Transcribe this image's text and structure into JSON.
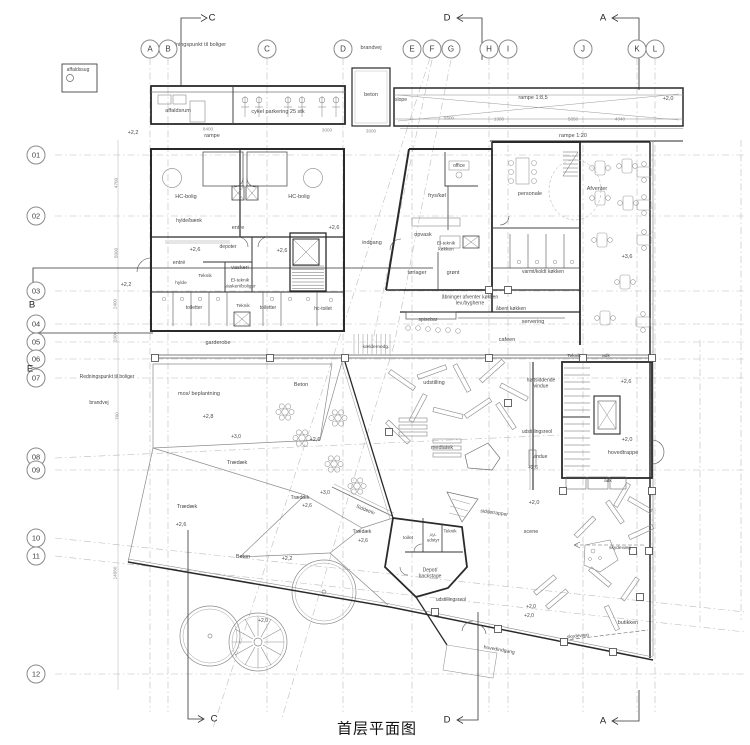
{
  "title": "首层平面图",
  "colors": {
    "wall": "#2a2a2a",
    "grid": "#b8b8b8",
    "label": "#4a4a4a",
    "furniture": "#909090"
  },
  "grid": {
    "column_bubble_y": 49,
    "row_bubble_x": 36,
    "columns": [
      {
        "label": "A",
        "x": 150
      },
      {
        "label": "B",
        "x": 168
      },
      {
        "label": "C",
        "x": 267
      },
      {
        "label": "D",
        "x": 343
      },
      {
        "label": "E",
        "x": 412
      },
      {
        "label": "F",
        "x": 432
      },
      {
        "label": "G",
        "x": 451
      },
      {
        "label": "H",
        "x": 489
      },
      {
        "label": "I",
        "x": 508
      },
      {
        "label": "J",
        "x": 583
      },
      {
        "label": "K",
        "x": 637
      },
      {
        "label": "L",
        "x": 655
      }
    ],
    "rows": [
      {
        "label": "01",
        "y": 155
      },
      {
        "label": "02",
        "y": 216
      },
      {
        "label": "03",
        "y": 291
      },
      {
        "label": "04",
        "y": 324
      },
      {
        "label": "05",
        "y": 342
      },
      {
        "label": "06",
        "y": 359
      },
      {
        "label": "07",
        "y": 378
      },
      {
        "label": "08",
        "y": 457
      },
      {
        "label": "09",
        "y": 470
      },
      {
        "label": "10",
        "y": 538
      },
      {
        "label": "11",
        "y": 556
      },
      {
        "label": "12",
        "y": 674
      }
    ]
  },
  "section_markers": [
    {
      "label": "C",
      "x": 212,
      "y": 18,
      "pos": "top"
    },
    {
      "label": "D",
      "x": 447,
      "y": 18,
      "pos": "top"
    },
    {
      "label": "A",
      "x": 603,
      "y": 18,
      "pos": "top"
    },
    {
      "label": "B",
      "x": 32,
      "y": 305,
      "pos": "left"
    },
    {
      "label": "E",
      "x": 30,
      "y": 369,
      "pos": "left"
    },
    {
      "label": "C",
      "x": 214,
      "y": 719,
      "pos": "bottom"
    },
    {
      "label": "D",
      "x": 447,
      "y": 720,
      "pos": "bottom"
    },
    {
      "label": "A",
      "x": 603,
      "y": 721,
      "pos": "bottom"
    }
  ],
  "labels": [
    {
      "t": "Redningspunkt til boliger",
      "x": 196,
      "y": 45,
      "s": 5.5
    },
    {
      "t": "brandvej",
      "x": 371,
      "y": 48,
      "s": 5.5
    },
    {
      "t": "affaldssug",
      "x": 78,
      "y": 71,
      "s": 5
    },
    {
      "t": "affaldsrum",
      "x": 178,
      "y": 111,
      "s": 5.5
    },
    {
      "t": "cykel parkering 25 stk",
      "x": 278,
      "y": 112,
      "s": 5.5
    },
    {
      "t": "beton",
      "x": 371,
      "y": 95,
      "s": 5.5
    },
    {
      "t": "rampe",
      "x": 212,
      "y": 136,
      "s": 5.5
    },
    {
      "t": "slope",
      "x": 401,
      "y": 101,
      "s": 5
    },
    {
      "t": "rampe 1:8,5",
      "x": 533,
      "y": 98,
      "s": 5.5
    },
    {
      "t": "rampe 1:20",
      "x": 573,
      "y": 136,
      "s": 5.5
    },
    {
      "t": "+2,0",
      "x": 668,
      "y": 99,
      "s": 5.5
    },
    {
      "t": "+2,2",
      "x": 133,
      "y": 133,
      "s": 5.5
    },
    {
      "t": "+2,2",
      "x": 126,
      "y": 285,
      "s": 5.5
    },
    {
      "t": "Redningspunkt til boliger",
      "x": 107,
      "y": 378,
      "s": 5
    },
    {
      "t": "brandvej",
      "x": 99,
      "y": 404,
      "s": 5
    },
    {
      "t": "HC-bolig",
      "x": 186,
      "y": 197,
      "s": 5.5
    },
    {
      "t": "HC-bolig",
      "x": 299,
      "y": 197,
      "s": 5.5
    },
    {
      "t": "hylde/bænk",
      "x": 189,
      "y": 222,
      "s": 5
    },
    {
      "t": "entre",
      "x": 238,
      "y": 228,
      "s": 5.5
    },
    {
      "t": "+2,6",
      "x": 334,
      "y": 228,
      "s": 5.5
    },
    {
      "t": "entré",
      "x": 179,
      "y": 263,
      "s": 5.5
    },
    {
      "t": "+2,6",
      "x": 195,
      "y": 250,
      "s": 5.5
    },
    {
      "t": "depoter",
      "x": 228,
      "y": 248,
      "s": 5
    },
    {
      "t": "+2,6",
      "x": 282,
      "y": 251,
      "s": 5.5
    },
    {
      "t": "vaskeri",
      "x": 240,
      "y": 268,
      "s": 5.5
    },
    {
      "t": "Teknik",
      "x": 205,
      "y": 277,
      "s": 4.8
    },
    {
      "t": "El-teknik\nVaskeri/boliger",
      "x": 240,
      "y": 284,
      "s": 4.8
    },
    {
      "t": "hylde",
      "x": 181,
      "y": 284,
      "s": 4.8
    },
    {
      "t": "toiletter",
      "x": 194,
      "y": 309,
      "s": 5
    },
    {
      "t": "Teknik",
      "x": 243,
      "y": 307,
      "s": 4.8
    },
    {
      "t": "toiletter",
      "x": 268,
      "y": 309,
      "s": 5
    },
    {
      "t": "hc-toilet",
      "x": 323,
      "y": 310,
      "s": 5
    },
    {
      "t": "garderobe",
      "x": 218,
      "y": 343,
      "s": 5.5
    },
    {
      "t": "kældernedg.",
      "x": 376,
      "y": 348,
      "s": 4.8
    },
    {
      "t": "office",
      "x": 459,
      "y": 167,
      "s": 5
    },
    {
      "t": "frys/køl",
      "x": 437,
      "y": 196,
      "s": 5.5
    },
    {
      "t": "personale",
      "x": 530,
      "y": 194,
      "s": 5.5
    },
    {
      "t": "indgang",
      "x": 372,
      "y": 243,
      "s": 5.5
    },
    {
      "t": "opvask",
      "x": 423,
      "y": 235,
      "s": 5.5
    },
    {
      "t": "El-teknik\nkøkken",
      "x": 446,
      "y": 247,
      "s": 4.8
    },
    {
      "t": "tørlager",
      "x": 417,
      "y": 273,
      "s": 5.5
    },
    {
      "t": "grønt",
      "x": 453,
      "y": 273,
      "s": 5.5
    },
    {
      "t": "varmt/koldt køkken",
      "x": 543,
      "y": 273,
      "s": 5
    },
    {
      "t": "Afventer",
      "x": 597,
      "y": 189,
      "s": 5.5
    },
    {
      "t": "+3,6",
      "x": 627,
      "y": 257,
      "s": 5.5
    },
    {
      "t": "åbninger afventer køkken\nlev./bygherre",
      "x": 470,
      "y": 301,
      "s": 5
    },
    {
      "t": "åbent køkken",
      "x": 511,
      "y": 310,
      "s": 5
    },
    {
      "t": "spisebar",
      "x": 428,
      "y": 321,
      "s": 5
    },
    {
      "t": "servering",
      "x": 533,
      "y": 322,
      "s": 5.5
    },
    {
      "t": "cafeen",
      "x": 507,
      "y": 340,
      "s": 5.5
    },
    {
      "t": "Teknik",
      "x": 574,
      "y": 357,
      "s": 4.8
    },
    {
      "t": "adk",
      "x": 606,
      "y": 357,
      "s": 4.8
    },
    {
      "t": "udstilling",
      "x": 434,
      "y": 383,
      "s": 5.5
    },
    {
      "t": "højtsiddende\nvindue",
      "x": 541,
      "y": 384,
      "s": 5
    },
    {
      "t": "udstillingsreol",
      "x": 537,
      "y": 433,
      "s": 5
    },
    {
      "t": "vindue",
      "x": 540,
      "y": 458,
      "s": 5
    },
    {
      "t": "+2,6",
      "x": 533,
      "y": 469,
      "s": 5
    },
    {
      "t": "mediatek",
      "x": 442,
      "y": 448,
      "s": 5.5
    },
    {
      "t": "+2,6",
      "x": 626,
      "y": 382,
      "s": 5.5
    },
    {
      "t": "+2,0",
      "x": 627,
      "y": 440,
      "s": 5.5
    },
    {
      "t": "hovedtrappe",
      "x": 623,
      "y": 453,
      "s": 5.5
    },
    {
      "t": "adk",
      "x": 608,
      "y": 482,
      "s": 4.8
    },
    {
      "t": "mos/ beplantning",
      "x": 199,
      "y": 394,
      "s": 5.5
    },
    {
      "t": "+2,8",
      "x": 208,
      "y": 417,
      "s": 5.5
    },
    {
      "t": "Beton",
      "x": 301,
      "y": 385,
      "s": 5.5
    },
    {
      "t": "+2,6",
      "x": 315,
      "y": 440,
      "s": 5.5
    },
    {
      "t": "+3,0",
      "x": 236,
      "y": 438,
      "s": 5
    },
    {
      "t": "Trædæk",
      "x": 237,
      "y": 463,
      "s": 5.5
    },
    {
      "t": "Trædæk",
      "x": 187,
      "y": 507,
      "s": 5.5
    },
    {
      "t": "+2,6",
      "x": 181,
      "y": 525,
      "s": 5.5
    },
    {
      "t": "+3,0",
      "x": 325,
      "y": 494,
      "s": 5
    },
    {
      "t": "Trædæk",
      "x": 300,
      "y": 499,
      "s": 5
    },
    {
      "t": "+2,6",
      "x": 307,
      "y": 507,
      "s": 5
    },
    {
      "t": "Siddetrin",
      "x": 365,
      "y": 511,
      "s": 5,
      "r": 22
    },
    {
      "t": "Trædæk",
      "x": 362,
      "y": 533,
      "s": 5
    },
    {
      "t": "+2,6",
      "x": 363,
      "y": 542,
      "s": 5
    },
    {
      "t": "Beton",
      "x": 243,
      "y": 557,
      "s": 5.5
    },
    {
      "t": "+2,2",
      "x": 287,
      "y": 559,
      "s": 5.5
    },
    {
      "t": "+2,0",
      "x": 263,
      "y": 622,
      "s": 5
    },
    {
      "t": "siddetrapper",
      "x": 494,
      "y": 514,
      "s": 5,
      "r": 8
    },
    {
      "t": "+2,0",
      "x": 534,
      "y": 503,
      "s": 5.5
    },
    {
      "t": "scene",
      "x": 531,
      "y": 532,
      "s": 5.5
    },
    {
      "t": "toilet",
      "x": 408,
      "y": 539,
      "s": 4.8
    },
    {
      "t": "AV-\nudstyr",
      "x": 433,
      "y": 538,
      "s": 4.6
    },
    {
      "t": "Teknik",
      "x": 450,
      "y": 531,
      "s": 4.6
    },
    {
      "t": "Depot/\nbackstage",
      "x": 430,
      "y": 574,
      "s": 5
    },
    {
      "t": "udstillingsreol",
      "x": 451,
      "y": 601,
      "s": 5
    },
    {
      "t": "+2,0",
      "x": 531,
      "y": 608,
      "s": 5
    },
    {
      "t": "skydevæg",
      "x": 620,
      "y": 549,
      "s": 4.8
    },
    {
      "t": "butikken",
      "x": 628,
      "y": 623,
      "s": 5.5
    },
    {
      "t": "skydevæg",
      "x": 578,
      "y": 637,
      "s": 4.8,
      "r": -6
    },
    {
      "t": "hovedindgang",
      "x": 499,
      "y": 651,
      "s": 5,
      "r": 10
    },
    {
      "t": "+2,0",
      "x": 529,
      "y": 617,
      "s": 5
    }
  ],
  "dimensions": [
    {
      "t": "8400",
      "x": 208,
      "y": 129
    },
    {
      "t": "3000",
      "x": 327,
      "y": 130
    },
    {
      "t": "3000",
      "x": 371,
      "y": 131
    },
    {
      "t": "5500",
      "x": 449,
      "y": 118
    },
    {
      "t": "1300",
      "x": 499,
      "y": 119
    },
    {
      "t": "5050",
      "x": 573,
      "y": 119
    },
    {
      "t": "4040",
      "x": 620,
      "y": 119
    },
    {
      "t": "4700",
      "x": 116,
      "y": 183,
      "r": -90
    },
    {
      "t": "5000",
      "x": 116,
      "y": 253,
      "r": -90
    },
    {
      "t": "2400",
      "x": 115,
      "y": 304,
      "r": -90
    },
    {
      "t": "2000",
      "x": 115,
      "y": 337,
      "r": -90
    },
    {
      "t": "700",
      "x": 117,
      "y": 416,
      "r": -90
    },
    {
      "t": "14080",
      "x": 115,
      "y": 573,
      "r": -90
    }
  ]
}
